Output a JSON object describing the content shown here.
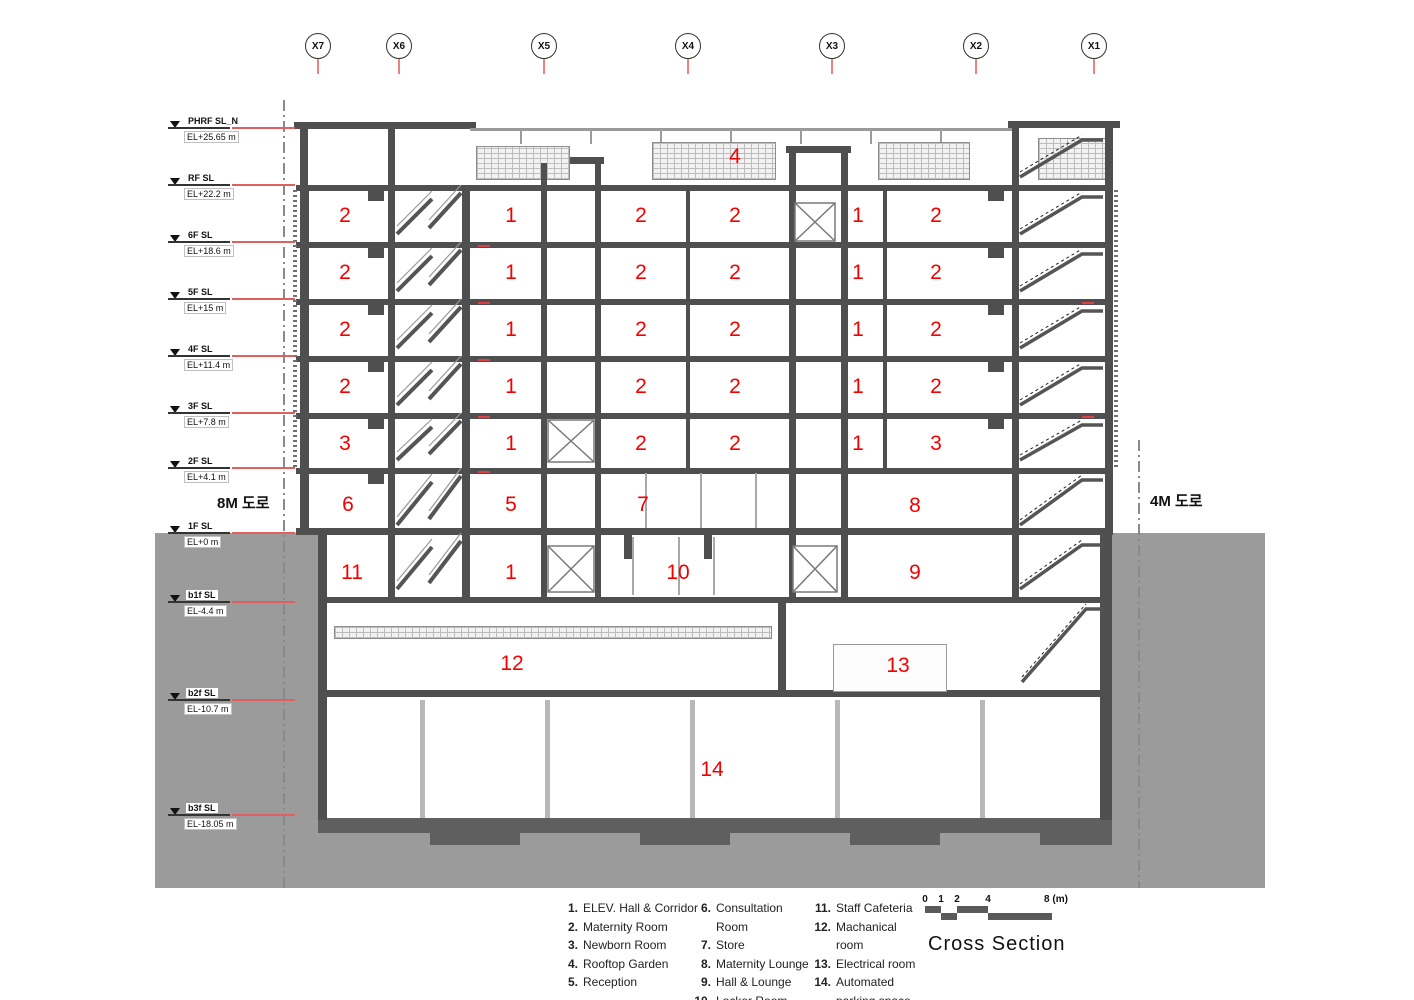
{
  "title": "Cross Section",
  "grid_markers": [
    {
      "label": "X7",
      "x": 318
    },
    {
      "label": "X6",
      "x": 399
    },
    {
      "label": "X5",
      "x": 544
    },
    {
      "label": "X4",
      "x": 688
    },
    {
      "label": "X3",
      "x": 832
    },
    {
      "label": "X2",
      "x": 976
    },
    {
      "label": "X1",
      "x": 1094
    }
  ],
  "levels": [
    {
      "name": "PHRF SL_N",
      "elevation": "EL+25.65 m",
      "y": 128
    },
    {
      "name": "RF SL",
      "elevation": "EL+22.2 m",
      "y": 185
    },
    {
      "name": "6F SL",
      "elevation": "EL+18.6 m",
      "y": 242
    },
    {
      "name": "5F SL",
      "elevation": "EL+15 m",
      "y": 299
    },
    {
      "name": "4F SL",
      "elevation": "EL+11.4 m",
      "y": 356
    },
    {
      "name": "3F SL",
      "elevation": "EL+7.8 m",
      "y": 413
    },
    {
      "name": "2F SL",
      "elevation": "EL+4.1 m",
      "y": 468
    },
    {
      "name": "1F SL",
      "elevation": "EL+0 m",
      "y": 533
    },
    {
      "name": "b1f SL",
      "elevation": "EL-4.4 m",
      "y": 602
    },
    {
      "name": "b2f SL",
      "elevation": "EL-10.7 m",
      "y": 700
    },
    {
      "name": "b3f SL",
      "elevation": "EL-18.05 m",
      "y": 815
    }
  ],
  "roads": {
    "left": "8M 도로",
    "right": "4M 도로"
  },
  "room_labels": [
    {
      "t": "4",
      "x": 735,
      "y": 157
    },
    {
      "t": "2",
      "x": 345,
      "y": 216
    },
    {
      "t": "1",
      "x": 511,
      "y": 216
    },
    {
      "t": "2",
      "x": 641,
      "y": 216
    },
    {
      "t": "2",
      "x": 735,
      "y": 216
    },
    {
      "t": "1",
      "x": 858,
      "y": 216
    },
    {
      "t": "2",
      "x": 936,
      "y": 216
    },
    {
      "t": "2",
      "x": 345,
      "y": 273
    },
    {
      "t": "1",
      "x": 511,
      "y": 273
    },
    {
      "t": "2",
      "x": 641,
      "y": 273
    },
    {
      "t": "2",
      "x": 735,
      "y": 273
    },
    {
      "t": "1",
      "x": 858,
      "y": 273
    },
    {
      "t": "2",
      "x": 936,
      "y": 273
    },
    {
      "t": "2",
      "x": 345,
      "y": 330
    },
    {
      "t": "1",
      "x": 511,
      "y": 330
    },
    {
      "t": "2",
      "x": 641,
      "y": 330
    },
    {
      "t": "2",
      "x": 735,
      "y": 330
    },
    {
      "t": "1",
      "x": 858,
      "y": 330
    },
    {
      "t": "2",
      "x": 936,
      "y": 330
    },
    {
      "t": "2",
      "x": 345,
      "y": 387
    },
    {
      "t": "1",
      "x": 511,
      "y": 387
    },
    {
      "t": "2",
      "x": 641,
      "y": 387
    },
    {
      "t": "2",
      "x": 735,
      "y": 387
    },
    {
      "t": "1",
      "x": 858,
      "y": 387
    },
    {
      "t": "2",
      "x": 936,
      "y": 387
    },
    {
      "t": "3",
      "x": 345,
      "y": 444
    },
    {
      "t": "1",
      "x": 511,
      "y": 444
    },
    {
      "t": "2",
      "x": 641,
      "y": 444
    },
    {
      "t": "2",
      "x": 735,
      "y": 444
    },
    {
      "t": "1",
      "x": 858,
      "y": 444
    },
    {
      "t": "3",
      "x": 936,
      "y": 444
    },
    {
      "t": "6",
      "x": 348,
      "y": 505
    },
    {
      "t": "5",
      "x": 511,
      "y": 505
    },
    {
      "t": "7",
      "x": 643,
      "y": 505
    },
    {
      "t": "8",
      "x": 915,
      "y": 506
    },
    {
      "t": "11",
      "x": 352,
      "y": 573
    },
    {
      "t": "1",
      "x": 511,
      "y": 573
    },
    {
      "t": "10",
      "x": 678,
      "y": 573
    },
    {
      "t": "9",
      "x": 915,
      "y": 573
    },
    {
      "t": "12",
      "x": 512,
      "y": 664
    },
    {
      "t": "13",
      "x": 898,
      "y": 666
    },
    {
      "t": "14",
      "x": 712,
      "y": 770
    }
  ],
  "legend": {
    "columns": [
      {
        "items": [
          {
            "num": "1.",
            "label": "ELEV. Hall & Corridor"
          },
          {
            "num": "2.",
            "label": "Maternity Room"
          },
          {
            "num": "3.",
            "label": "Newborn Room"
          },
          {
            "num": "4.",
            "label": "Rooftop Garden"
          },
          {
            "num": "5.",
            "label": "Reception"
          }
        ]
      },
      {
        "items": [
          {
            "num": "6.",
            "label": "Consultation Room"
          },
          {
            "num": "7.",
            "label": "Store"
          },
          {
            "num": "8.",
            "label": "Maternity Lounge"
          },
          {
            "num": "9.",
            "label": "Hall & Lounge"
          },
          {
            "num": "10.",
            "label": "Locker Room"
          }
        ]
      },
      {
        "items": [
          {
            "num": "11.",
            "label": "Staff Cafeteria"
          },
          {
            "num": "12.",
            "label": "Machanical room"
          },
          {
            "num": "13.",
            "label": "Electrical room"
          },
          {
            "num": "14.",
            "label": "Automated parking space"
          }
        ]
      }
    ]
  },
  "scale_bar": {
    "ticks": [
      {
        "label": "0",
        "x": 925
      },
      {
        "label": "1",
        "x": 941
      },
      {
        "label": "2",
        "x": 957
      },
      {
        "label": "4",
        "x": 988
      },
      {
        "label": "8 (m)",
        "x": 1056
      }
    ]
  },
  "colors": {
    "wall": "#4f4f4f",
    "ground": "#9b9b9b",
    "room_red": "#f40000",
    "level_red": "#e06060",
    "tick_red": "#ef8080"
  }
}
